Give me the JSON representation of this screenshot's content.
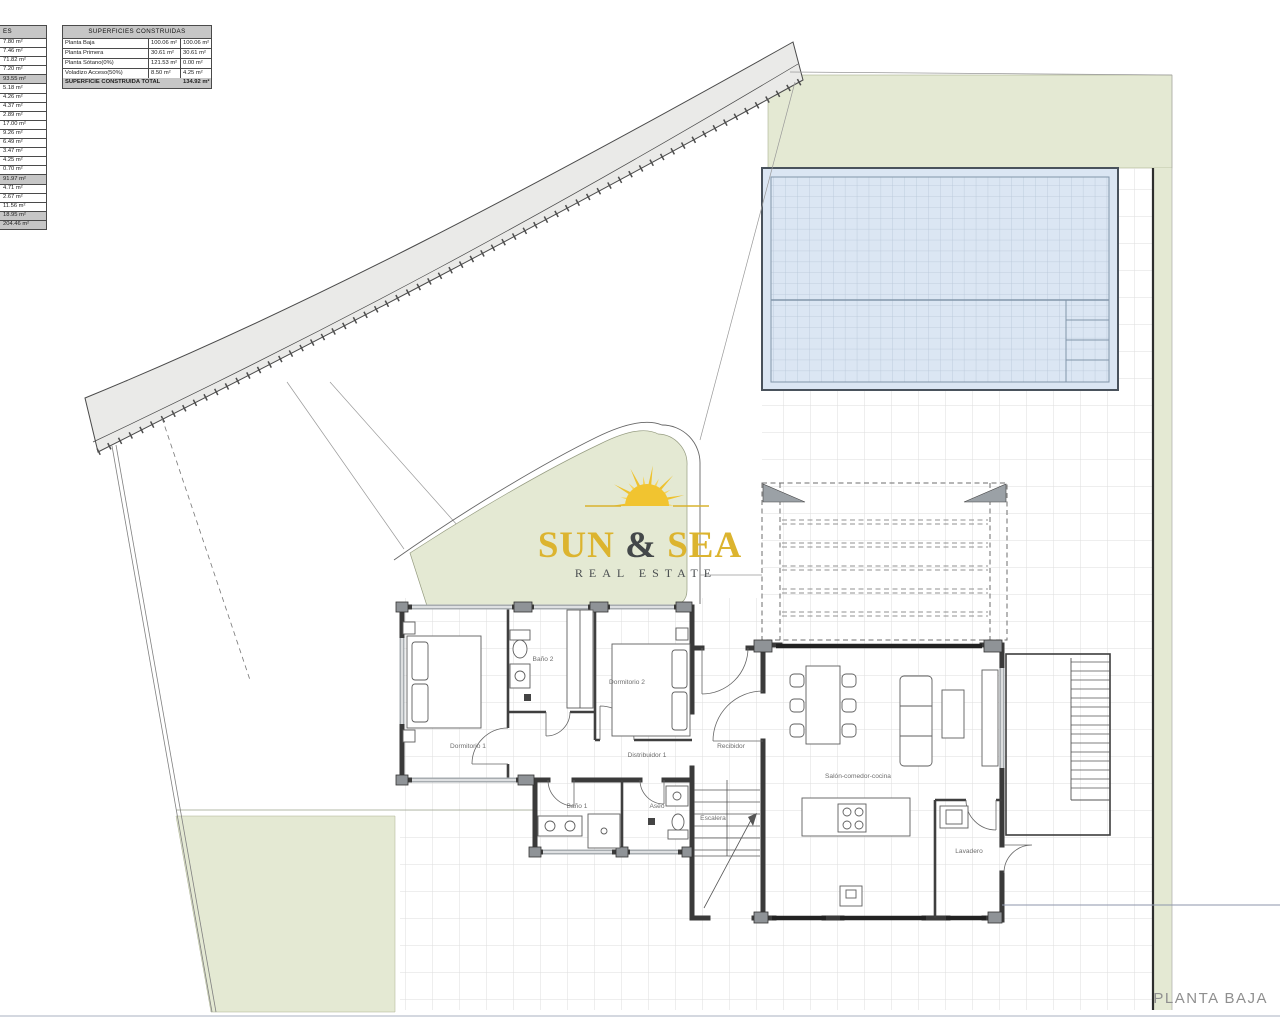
{
  "tables": {
    "superficies_utiles": {
      "header": "ES",
      "rows": [
        {
          "value": "7.80 m²",
          "shaded": false
        },
        {
          "value": "7.46 m²",
          "shaded": false
        },
        {
          "value": "71.82 m²",
          "shaded": false
        },
        {
          "value": "7.20 m²",
          "shaded": false
        },
        {
          "value": "93.55 m²",
          "shaded": true
        },
        {
          "value": "5.18 m²",
          "shaded": false
        },
        {
          "value": "4.26 m²",
          "shaded": false
        },
        {
          "value": "4.37 m²",
          "shaded": false
        },
        {
          "value": "2.89 m²",
          "shaded": false
        },
        {
          "value": "17.00 m²",
          "shaded": false
        },
        {
          "value": "9.26 m²",
          "shaded": false
        },
        {
          "value": "6.49 m²",
          "shaded": false
        },
        {
          "value": "3.47 m²",
          "shaded": false
        },
        {
          "value": "4.25 m²",
          "shaded": false
        },
        {
          "value": "0.70 m²",
          "shaded": false
        },
        {
          "value": "91.97 m²",
          "shaded": true
        },
        {
          "value": "4.71 m²",
          "shaded": false
        },
        {
          "value": "2.67 m²",
          "shaded": false
        },
        {
          "value": "11.56 m²",
          "shaded": false
        },
        {
          "value": "18.95 m²",
          "shaded": true
        },
        {
          "value": "204.46 m²",
          "shaded": true
        }
      ]
    },
    "superficies_construidas": {
      "title": "SUPERFICIES CONSTRUIDAS",
      "rows": [
        {
          "label": "Planta Baja",
          "col1": "100.06 m²",
          "col2": "100.06 m²"
        },
        {
          "label": "Planta Primera",
          "col1": "30.61 m²",
          "col2": "30.61 m²"
        },
        {
          "label": "Planta Sótano(0%)",
          "col1": "121.53 m²",
          "col2": "0.00 m²"
        },
        {
          "label": "Voladizo Acceso(50%)",
          "col1": "8.50 m²",
          "col2": "4.25 m²"
        }
      ],
      "total_label": "SUPERFICIE CONSTRUIDA TOTAL",
      "total_value": "134.92 m²"
    }
  },
  "logo": {
    "brand_sun": "SUN",
    "brand_amp": " & ",
    "brand_sea": "SEA",
    "tagline": "REAL ESTATE"
  },
  "rooms": {
    "dormitorio1": "Dormitorio 1",
    "bano2": "Baño 2",
    "dormitorio2": "Dormitorio 2",
    "distribuidor": "Distribuidor 1",
    "recibidor": "Recibidor",
    "bano1": "Baño 1",
    "aseo": "Aseo",
    "escalera": "Escalera",
    "salon": "Salón-comedor-cocina",
    "lavadero": "Lavadero"
  },
  "title": {
    "plan_label": "PLANTA BAJA"
  },
  "colors": {
    "garden_green": "#e4e9d3",
    "pool_blue": "#dbe6f3",
    "road_grey": "#eaeae8",
    "wall_dark": "#3a3a3a",
    "logo_gold": "#dcb42f",
    "logo_dark": "#44484a"
  }
}
